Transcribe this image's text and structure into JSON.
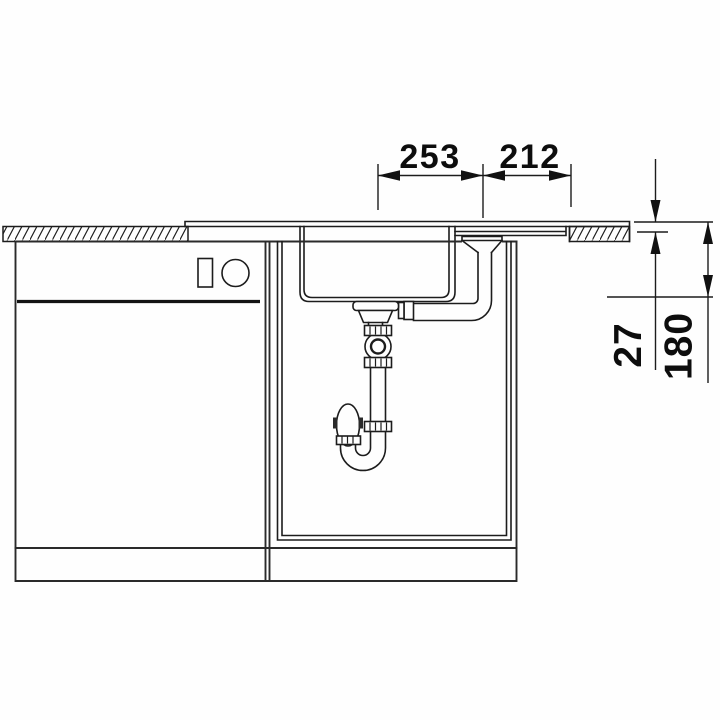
{
  "drawing": {
    "kind": "kitchen sink installation cross-section technical drawing",
    "dimension_labels": {
      "top_left": "253",
      "top_right": "212",
      "right_inner": "27",
      "right_outer": "180"
    },
    "colors": {
      "line": "#1c1c1c",
      "background": "#ffffff"
    }
  }
}
